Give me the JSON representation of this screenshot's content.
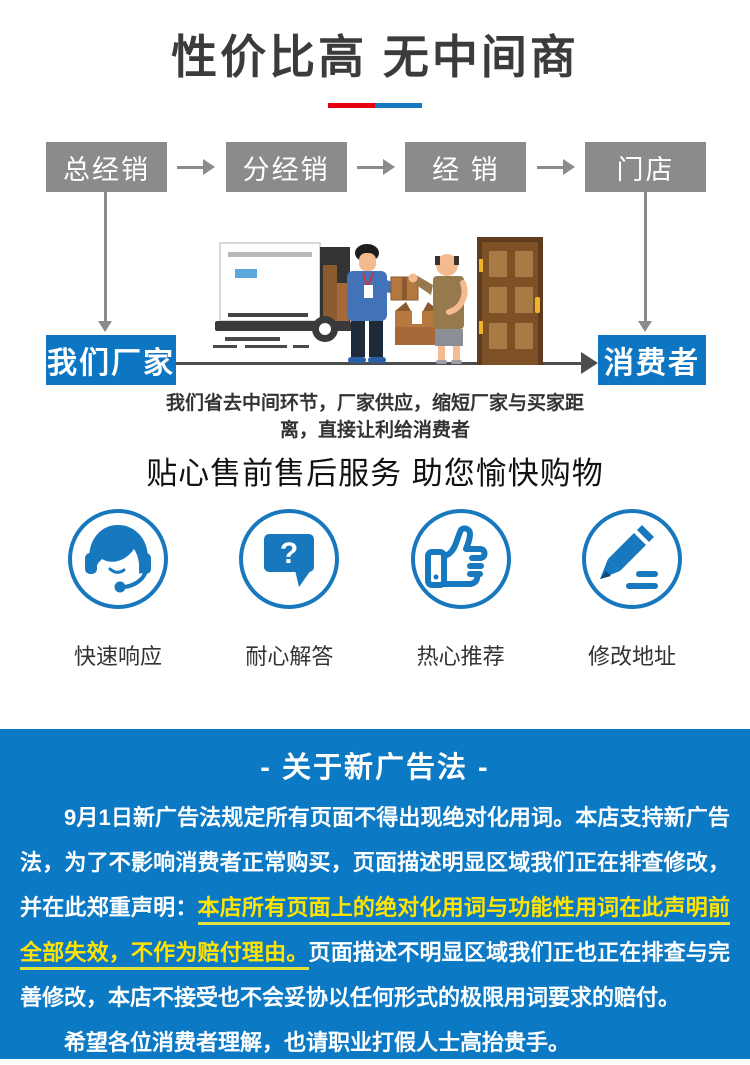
{
  "header": {
    "title": "性价比高 无中间商",
    "accent_red": "#e60012",
    "accent_blue": "#1678be"
  },
  "flow": {
    "chain": [
      "总经销",
      "分经销",
      "经 销",
      "门店"
    ],
    "factory_label": "我们厂家",
    "consumer_label": "消费者",
    "box_gray": "#8b8b8b",
    "box_blue": "#0d76c3",
    "caption": "我们省去中间环节，厂家供应，缩短厂家与买家距离，直接让利给消费者"
  },
  "services": {
    "title": "贴心售前售后服务 助您愉快购物",
    "icon_blue": "#1878be",
    "items": [
      {
        "icon": "headset-icon",
        "label": "快速响应"
      },
      {
        "icon": "question-bubble-icon",
        "label": "耐心解答"
      },
      {
        "icon": "thumbs-up-icon",
        "label": "热心推荐"
      },
      {
        "icon": "pencil-icon",
        "label": "修改地址"
      }
    ]
  },
  "notice": {
    "title": "- 关于新广告法 -",
    "bg_color": "#0c79c5",
    "highlight_color": "#ffe400",
    "para1_part1": "9月1日新广告法规定所有页面不得出现绝对化用词。本店支持新广告法，为了不影响消费者正常购买，页面描述明显区域我们正在排查修改，并在此郑重声明：",
    "para1_highlight": "本店所有页面上的绝对化用词与功能性用词在此声明前全部失效，不作为赔付理由。",
    "para1_part2": "页面描述不明显区域我们正也正在排查与完善修改，本店不接受也不会妥协以任何形式的极限用词要求的赔付。",
    "para2": "希望各位消费者理解，也请职业打假人士高抬贵手。"
  }
}
